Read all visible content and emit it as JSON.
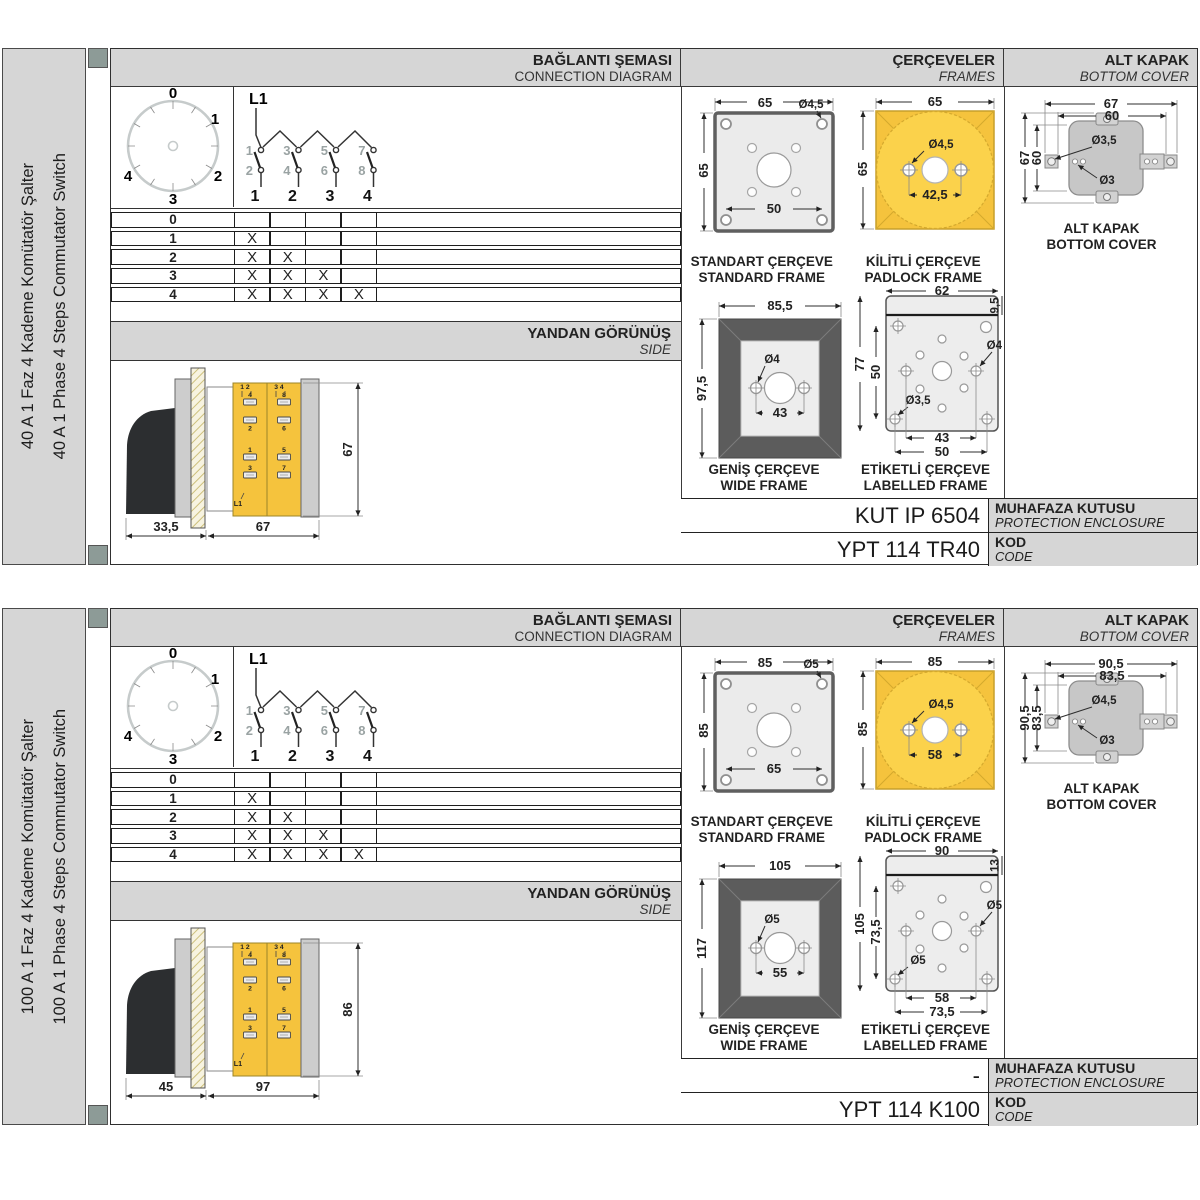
{
  "headers": {
    "connection": {
      "tr": "BAĞLANTI ŞEMASI",
      "en": "CONNECTION DIAGRAM"
    },
    "frames": {
      "tr": "ÇERÇEVELER",
      "en": "FRAMES"
    },
    "bottom_cover": {
      "tr": "ALT KAPAK",
      "en": "BOTTOM COVER"
    },
    "side": {
      "tr": "YANDAN GÖRÜNÜŞ",
      "en": "SIDE"
    },
    "enclosure": {
      "tr": "MUHAFAZA KUTUSU",
      "en": "PROTECTION ENCLOSURE"
    },
    "code": {
      "tr": "KOD",
      "en": "CODE"
    }
  },
  "connection_diagram": {
    "input_label": "L1",
    "dial_positions": [
      "0",
      "1",
      "2",
      "3",
      "4"
    ],
    "contacts_top": [
      "1",
      "3",
      "5",
      "7"
    ],
    "contacts_bottom": [
      "2",
      "4",
      "6",
      "8"
    ],
    "outputs": [
      "1",
      "2",
      "3",
      "4"
    ],
    "table_rows": [
      {
        "pos": "0",
        "m": [
          "",
          "",
          "",
          ""
        ]
      },
      {
        "pos": "1",
        "m": [
          "X",
          "",
          "",
          ""
        ]
      },
      {
        "pos": "2",
        "m": [
          "X",
          "X",
          "",
          ""
        ]
      },
      {
        "pos": "3",
        "m": [
          "X",
          "X",
          "X",
          ""
        ]
      },
      {
        "pos": "4",
        "m": [
          "X",
          "X",
          "X",
          "X"
        ]
      }
    ]
  },
  "side_terminals": {
    "left_header": "1 2",
    "right_header": "3 4",
    "left_upper": [
      "4",
      "2"
    ],
    "right_upper": [
      "8",
      "6"
    ],
    "left_lower": [
      "1",
      "3"
    ],
    "right_lower": [
      "5",
      "7"
    ],
    "input": "L1"
  },
  "frame_captions": {
    "standard": {
      "tr": "STANDART ÇERÇEVE",
      "en": "STANDARD FRAME"
    },
    "padlock": {
      "tr": "KİLİTLİ ÇERÇEVE",
      "en": "PADLOCK FRAME"
    },
    "wide": {
      "tr": "GENİŞ ÇERÇEVE",
      "en": "WIDE FRAME"
    },
    "labelled": {
      "tr": "ETİKETLİ ÇERÇEVE",
      "en": "LABELLED FRAME"
    }
  },
  "cover_caption": {
    "tr": "ALT KAPAK",
    "en": "BOTTOM COVER"
  },
  "colors": {
    "accent_square": "#8d9b97",
    "panel_gray": "#d6d6d6",
    "yellow": "#f5c33d",
    "yellow_light": "#fbd24b",
    "frame_dark": "#5c5c5c"
  },
  "modules": [
    {
      "sidebar": {
        "tr": "40 A 1 Faz 4 Kademe Komütatör Şalter",
        "en": "40 A 1 Phase 4 Steps Commutator Switch"
      },
      "side_view": {
        "a": "33,5",
        "b": "67",
        "h": "67"
      },
      "standard_frame": {
        "w": "65",
        "h": "65",
        "hole": "Ø4,5",
        "pitch": "50"
      },
      "padlock_frame": {
        "w": "65",
        "h": "65",
        "hole": "Ø4,5",
        "pitch": "42,5"
      },
      "wide_frame": {
        "w": "85,5",
        "h": "97,5",
        "hole": "Ø4",
        "pitch": "43"
      },
      "labelled_frame": {
        "w": "62",
        "band": "9,5",
        "h": "77",
        "inner": "50",
        "hole_side": "Ø4",
        "hole_corner": "Ø3,5",
        "pitch1": "43",
        "pitch2": "50"
      },
      "bottom_cover": {
        "w1": "67",
        "w2": "60",
        "h1": "67",
        "h2": "60",
        "hole1": "Ø3,5",
        "hole2": "Ø3"
      },
      "enclosure_value": "KUT IP 6504",
      "code_value": "YPT 114 TR40"
    },
    {
      "sidebar": {
        "tr": "100 A 1 Faz 4 Kademe Komütatör Şalter",
        "en": "100 A 1 Phase 4 Steps Commutator Switch"
      },
      "side_view": {
        "a": "45",
        "b": "97",
        "h": "86"
      },
      "standard_frame": {
        "w": "85",
        "h": "85",
        "hole": "Ø5",
        "pitch": "65"
      },
      "padlock_frame": {
        "w": "85",
        "h": "85",
        "hole": "Ø4,5",
        "pitch": "58"
      },
      "wide_frame": {
        "w": "105",
        "h": "117",
        "hole": "Ø5",
        "pitch": "55"
      },
      "labelled_frame": {
        "w": "90",
        "band": "13",
        "h": "105",
        "inner": "73,5",
        "hole_side": "Ø5",
        "hole_corner": "Ø5",
        "pitch1": "58",
        "pitch2": "73,5"
      },
      "bottom_cover": {
        "w1": "90,5",
        "w2": "83,5",
        "h1": "90,5",
        "h2": "83,5",
        "hole1": "Ø4,5",
        "hole2": "Ø3"
      },
      "enclosure_value": "-",
      "code_value": "YPT 114 K100"
    }
  ]
}
